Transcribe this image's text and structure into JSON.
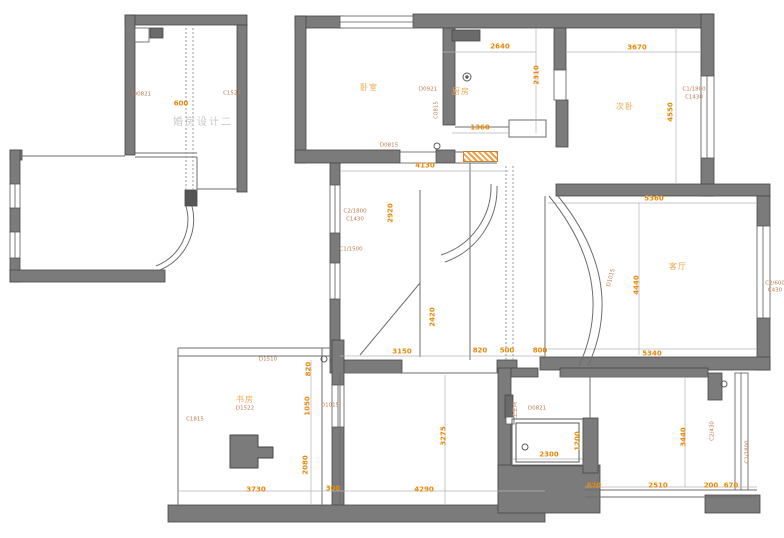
{
  "title": "apartment-floor-plan",
  "colors": {
    "wall": "#7b7b7b",
    "wall_stroke": "#474747",
    "thin_line": "#6e6e6e",
    "dimension_text": "#e8890c",
    "code_text": "#bc7b4f",
    "room_text": "#f0aa55",
    "watermark_text": "#c9c9c9"
  },
  "watermark": {
    "text": "婚房设计二"
  },
  "labels": [
    {
      "t": "2640",
      "x": 500,
      "y": 47,
      "c": "dim"
    },
    {
      "t": "2310",
      "x": 537,
      "y": 75,
      "r": -90,
      "c": "dim"
    },
    {
      "t": "3670",
      "x": 637,
      "y": 48,
      "c": "dim"
    },
    {
      "t": "4550",
      "x": 671,
      "y": 112,
      "r": -90,
      "c": "dim"
    },
    {
      "t": "1360",
      "x": 480,
      "y": 128,
      "c": "dim"
    },
    {
      "t": "4130",
      "x": 425,
      "y": 166,
      "c": "dim"
    },
    {
      "t": "2920",
      "x": 391,
      "y": 213,
      "r": -90,
      "c": "dim"
    },
    {
      "t": "5360",
      "x": 654,
      "y": 199,
      "c": "dim"
    },
    {
      "t": "4440",
      "x": 637,
      "y": 285,
      "r": -90,
      "c": "dim"
    },
    {
      "t": "5340",
      "x": 652,
      "y": 354,
      "c": "dim"
    },
    {
      "t": "3150",
      "x": 402,
      "y": 352,
      "c": "dim"
    },
    {
      "t": "820",
      "x": 480,
      "y": 351,
      "c": "dim"
    },
    {
      "t": "500",
      "x": 507,
      "y": 351,
      "c": "dim"
    },
    {
      "t": "800",
      "x": 540,
      "y": 351,
      "c": "dim"
    },
    {
      "t": "2420",
      "x": 433,
      "y": 317,
      "r": -90,
      "c": "dim"
    },
    {
      "t": "820",
      "x": 309,
      "y": 369,
      "r": -90,
      "c": "dim"
    },
    {
      "t": "1050",
      "x": 308,
      "y": 406,
      "r": -90,
      "c": "dim"
    },
    {
      "t": "2080",
      "x": 306,
      "y": 465,
      "r": -90,
      "c": "dim"
    },
    {
      "t": "3730",
      "x": 256,
      "y": 490,
      "c": "dim"
    },
    {
      "t": "300",
      "x": 333,
      "y": 489,
      "c": "dim"
    },
    {
      "t": "4290",
      "x": 424,
      "y": 490,
      "c": "dim"
    },
    {
      "t": "3275",
      "x": 444,
      "y": 436,
      "r": -90,
      "c": "dim"
    },
    {
      "t": "2300",
      "x": 549,
      "y": 455,
      "c": "dim"
    },
    {
      "t": "1200",
      "x": 578,
      "y": 441,
      "r": -90,
      "c": "dim"
    },
    {
      "t": "620",
      "x": 594,
      "y": 486,
      "c": "dim"
    },
    {
      "t": "2510",
      "x": 658,
      "y": 486,
      "c": "dim"
    },
    {
      "t": "200",
      "x": 711,
      "y": 486,
      "c": "dim"
    },
    {
      "t": "670",
      "x": 731,
      "y": 486,
      "c": "dim"
    },
    {
      "t": "3440",
      "x": 684,
      "y": 437,
      "r": -90,
      "c": "dim"
    },
    {
      "t": "600",
      "x": 181,
      "y": 104,
      "c": "dim"
    },
    {
      "t": "D0821",
      "x": 142,
      "y": 95,
      "c": "code"
    },
    {
      "t": "C1524",
      "x": 232,
      "y": 94,
      "c": "code"
    },
    {
      "t": "D0921",
      "x": 428,
      "y": 90,
      "c": "code"
    },
    {
      "t": "C0815",
      "x": 437,
      "y": 110,
      "r": -90,
      "c": "code"
    },
    {
      "t": "D0815",
      "x": 389,
      "y": 146,
      "c": "code"
    },
    {
      "t": "C2/1800",
      "x": 355,
      "y": 212,
      "c": "code"
    },
    {
      "t": "C1430",
      "x": 355,
      "y": 220,
      "c": "code"
    },
    {
      "t": "C1/1500",
      "x": 351,
      "y": 250,
      "c": "code"
    },
    {
      "t": "C1/1800",
      "x": 694,
      "y": 90,
      "c": "code"
    },
    {
      "t": "C1430",
      "x": 694,
      "y": 98,
      "c": "code"
    },
    {
      "t": "D1015",
      "x": 612,
      "y": 278,
      "r": -75,
      "c": "code"
    },
    {
      "t": "C2/600",
      "x": 775,
      "y": 284,
      "c": "code"
    },
    {
      "t": "C430",
      "x": 775,
      "y": 291,
      "c": "code"
    },
    {
      "t": "D1015",
      "x": 330,
      "y": 406,
      "c": "code"
    },
    {
      "t": "D1510",
      "x": 268,
      "y": 360,
      "c": "code"
    },
    {
      "t": "C1815",
      "x": 195,
      "y": 420,
      "c": "code"
    },
    {
      "t": "D1522",
      "x": 245,
      "y": 409,
      "c": "code"
    },
    {
      "t": "D0821",
      "x": 537,
      "y": 409,
      "c": "code"
    },
    {
      "t": "C2/430",
      "x": 713,
      "y": 431,
      "r": -90,
      "c": "code"
    },
    {
      "t": "C1/1800",
      "x": 748,
      "y": 452,
      "r": -90,
      "c": "code"
    },
    {
      "t": "卧室",
      "x": 369,
      "y": 88,
      "c": "room"
    },
    {
      "t": "厨房",
      "x": 461,
      "y": 92,
      "c": "room"
    },
    {
      "t": "次卧",
      "x": 625,
      "y": 107,
      "c": "room"
    },
    {
      "t": "客厅",
      "x": 678,
      "y": 267,
      "c": "room"
    },
    {
      "t": "书房",
      "x": 245,
      "y": 400,
      "c": "room"
    },
    {
      "t": "卫生间",
      "x": 516,
      "y": 410,
      "r": -90,
      "c": "code"
    },
    {
      "t": "婚房设计二",
      "x": 203,
      "y": 123,
      "c": "wm"
    }
  ]
}
